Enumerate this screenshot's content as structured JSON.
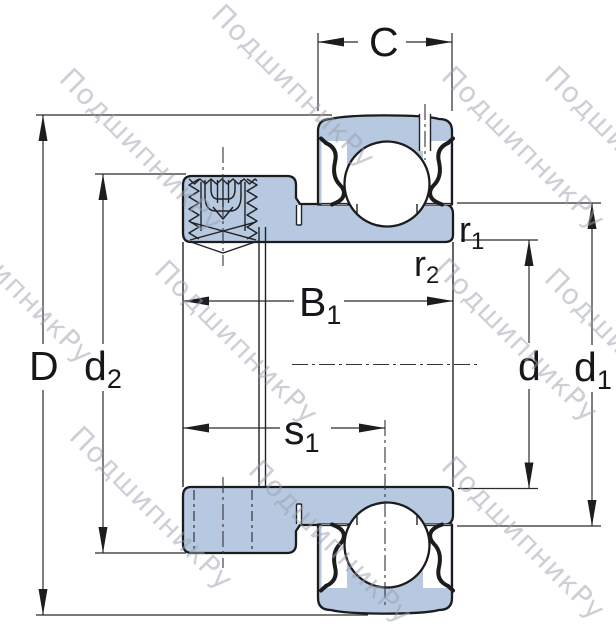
{
  "title": "Insert ball bearing cross-section technical drawing",
  "watermark": {
    "text": "ПодшипникРу"
  },
  "colors": {
    "part_fill": "#b6c9e0",
    "outline": "#1c1c1e",
    "dimension": "#2a2a2a",
    "watermark": "#9aa0ac",
    "background": "#ffffff"
  },
  "labels": {
    "C": "C",
    "D": "D",
    "d2": {
      "main": "d",
      "sub": "2"
    },
    "B1": {
      "main": "B",
      "sub": "1"
    },
    "s1": {
      "main": "s",
      "sub": "1"
    },
    "r1": {
      "main": "r",
      "sub": "1"
    },
    "r2": {
      "main": "r",
      "sub": "2"
    },
    "d": "d",
    "d1": {
      "main": "d",
      "sub": "1"
    }
  }
}
